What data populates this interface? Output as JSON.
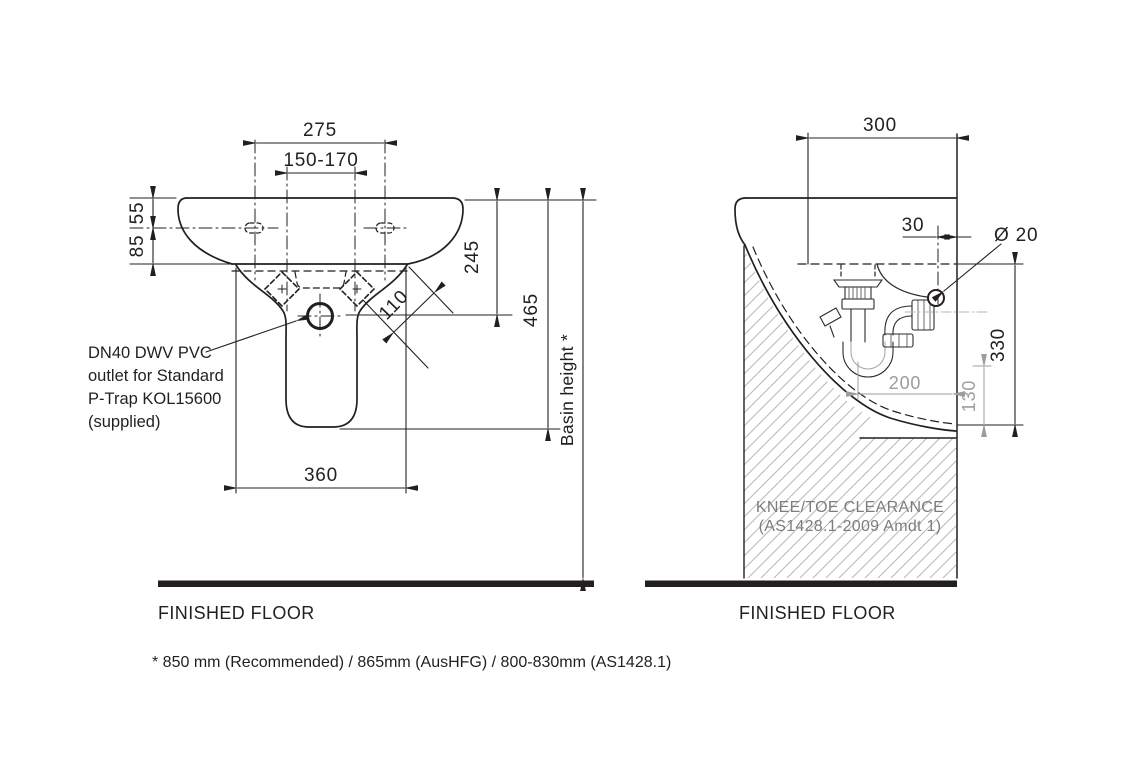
{
  "front_view": {
    "dims": {
      "d275": "275",
      "d150_170": "150-170",
      "d55": "55",
      "d85": "85",
      "d245": "245",
      "d465": "465",
      "d110": "110",
      "d360": "360"
    },
    "basin_height_label": "Basin height *",
    "outlet_note": {
      "l1": "DN40 DWV PVC",
      "l2": "outlet for Standard",
      "l3": "P-Trap KOL15600",
      "l4": "(supplied)"
    },
    "floor_label": "FINISHED FLOOR"
  },
  "side_view": {
    "dims": {
      "d300": "300",
      "d30": "30",
      "dia20": "Ø 20",
      "d330": "330",
      "d200": "200",
      "d130": "130"
    },
    "clearance": {
      "l1": "KNEE/TOE CLEARANCE",
      "l2": "(AS1428.1-2009 Amdt 1)"
    },
    "floor_label": "FINISHED FLOOR"
  },
  "footnote": "* 850 mm (Recommended) / 865mm (AusHFG) / 800-830mm (AS1428.1)",
  "colors": {
    "line": "#231f20",
    "gray_dim": "#9b9da0",
    "gray_text": "#7b7d80",
    "hatch": "#b6b8ba",
    "background": "#ffffff"
  }
}
